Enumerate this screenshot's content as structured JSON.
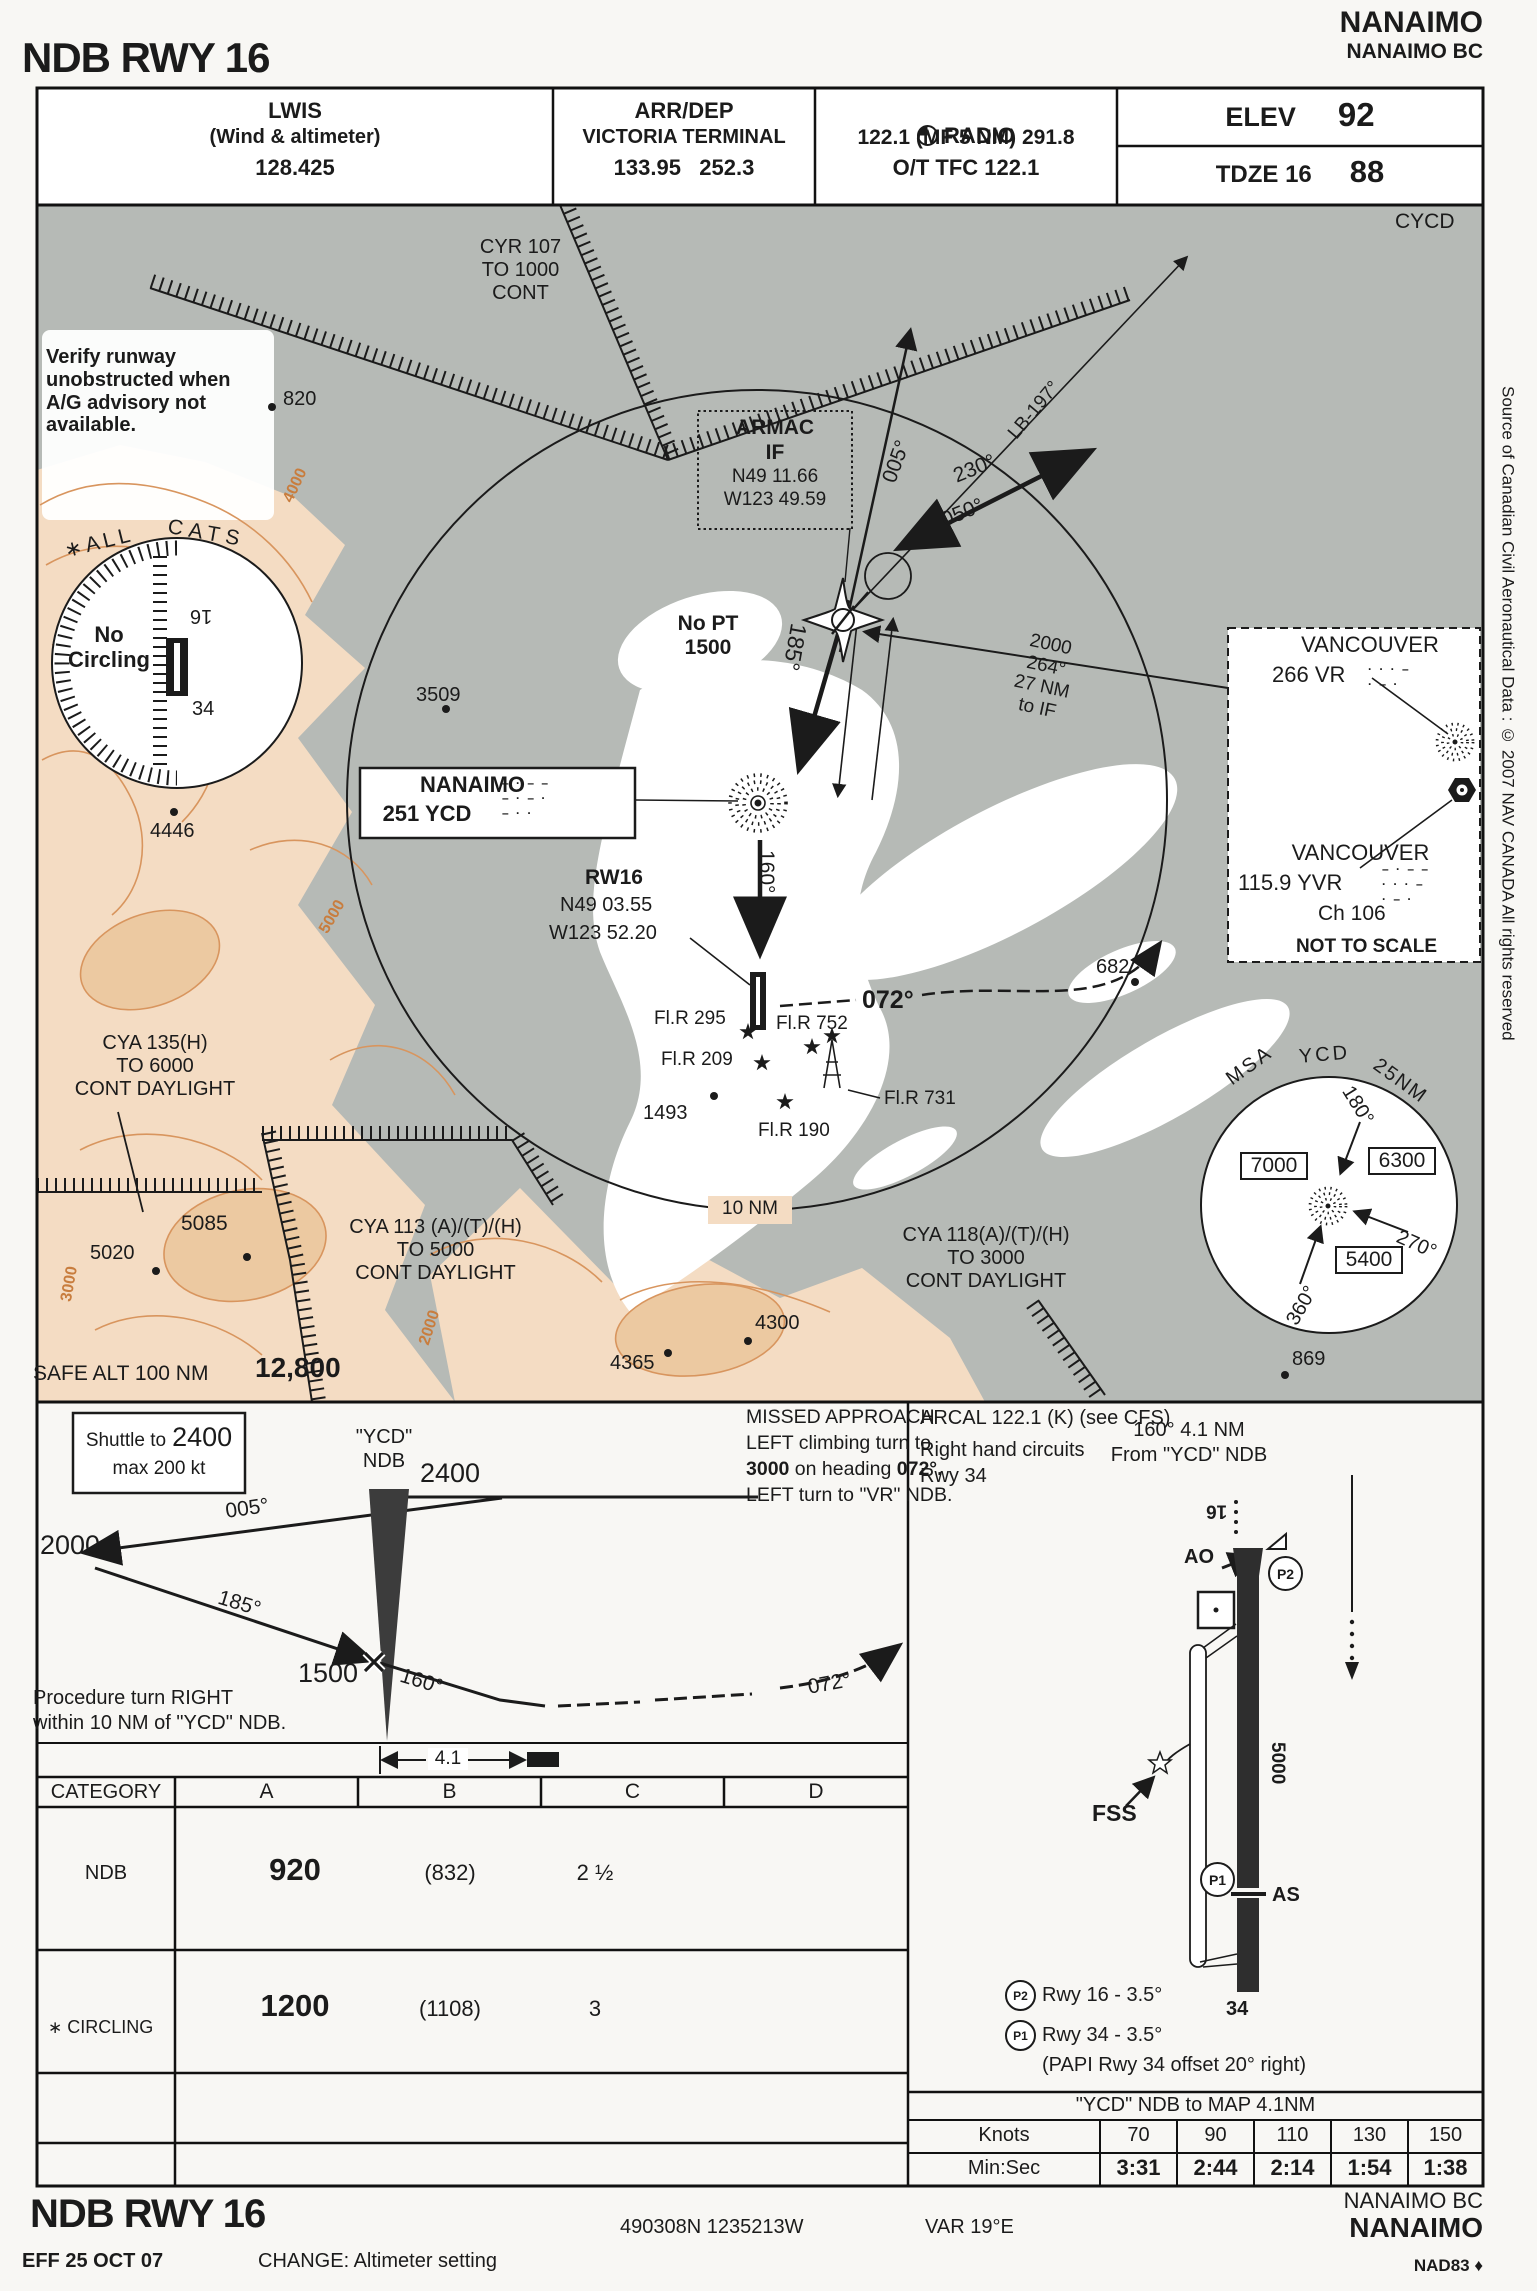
{
  "colors": {
    "water": "#b6bab6",
    "terrain": "#f4dcc3",
    "contour": "#d8955e",
    "ink": "#1b1b1b"
  },
  "header": {
    "title": "NDB RWY 16",
    "name": "NANAIMO",
    "location": "NANAIMO BC",
    "lwis": {
      "l1": "LWIS",
      "l2": "(Wind & altimeter)",
      "l3": "128.425"
    },
    "arrdep": {
      "l1": "ARR/DEP",
      "l2": "VICTORIA TERMINAL",
      "l3": "133.95   252.3"
    },
    "radio": {
      "l1": "RADIO",
      "l2": "122.1 (MF 5 NM) 291.8",
      "l3": "O/T TFC 122.1"
    },
    "elev_label": "ELEV",
    "elev": "92",
    "tdze_label": "TDZE 16",
    "tdze": "88"
  },
  "map": {
    "icao": "CYCD",
    "verify_note": "Verify runway\nunobstructed when\nA/G advisory not\navailable.",
    "cyr107": "CYR 107\nTO 1000\nCONT",
    "all_cats_1": "∗ALL",
    "all_cats_2": "CATS",
    "no_circling": "No\nCircling",
    "nc_16": "16",
    "nc_34": "34",
    "spot_820": "820",
    "spot_4446": "4446",
    "spot_3509": "3509",
    "spot_682": "682",
    "spot_1493": "1493",
    "spot_5085": "5085",
    "spot_5020": "5020",
    "spot_4300": "4300",
    "spot_4365": "4365",
    "spot_869": "869",
    "armac_name": "ARMAC",
    "armac_if": "IF",
    "armac_lat": "N49 11.66",
    "armac_lon": "W123 49.59",
    "brg_005": "005°",
    "brg_230": "230°",
    "brg_050": "050°",
    "lb_197": "LB-197°",
    "brg_185": "185°",
    "brg_160": "160°",
    "brg_072": "072°",
    "no_pt": "No PT\n1500",
    "feeder": "2000\n264°\n27 NM\nto IF",
    "ndb_name": "NANAIMO",
    "ndb_freq": "251 YCD",
    "ndb_morse": "– · – –\n– · – ·\n– · ·",
    "rw16": "RW16",
    "rw16_lat": "N49 03.55",
    "rw16_lon": "W123 52.20",
    "flr_295": "Fl.R 295",
    "flr_752": "Fl.R 752",
    "flr_209": "Fl.R 209",
    "flr_731": "Fl.R 731",
    "flr_190": "Fl.R 190",
    "cya_135": "CYA 135(H)\nTO 6000\nCONT DAYLIGHT",
    "cya_113": "CYA 113 (A)/(T)/(H)\nTO 5000\nCONT DAYLIGHT",
    "cya_118": "CYA 118(A)/(T)/(H)\nTO 3000\nCONT DAYLIGHT",
    "ring_10nm": "10  NM",
    "safe_alt_label": "SAFE ALT 100 NM",
    "safe_alt_value": "12,800",
    "contour_4000": "4000",
    "contour_3000": "3000",
    "contour_2000": "2000",
    "contour_5000": "5000"
  },
  "inset": {
    "name1": "VANCOUVER",
    "id1": "266 VR",
    "morse1": "· · · –\n· – ·",
    "name2": "VANCOUVER",
    "id2": "115.9 YVR",
    "morse2": "– · – –\n· · · –\n· – ·",
    "ch": "Ch 106",
    "nts": "NOT TO SCALE"
  },
  "msa": {
    "t1": "MSA",
    "t2": "YCD",
    "t3": "25NM",
    "v_w": "7000",
    "v_e": "6300",
    "v_s": "5400",
    "b180": "180°",
    "b270": "270°",
    "b360": "360°"
  },
  "margin_note": "Source of Canadian Civil Aeronautical Data : © 2007 NAV CANADA All rights reserved",
  "profile": {
    "shuttle_pre": "Shuttle to",
    "shuttle_alt": "2400",
    "shuttle_max": "max 200 kt",
    "alt2000": "2000",
    "brg005": "005°",
    "brg185": "185°",
    "alt1500": "1500",
    "brg160": "160°",
    "brg072": "072°",
    "ndb_q": "\"YCD\"",
    "ndb_lbl": "NDB",
    "alt2400": "2400",
    "proc_turn": "Procedure turn RIGHT\nwithin 10 NM of \"YCD\" NDB.",
    "dist": "4.1"
  },
  "missed": {
    "l1": "MISSED APPROACH",
    "l2": "LEFT climbing turn to",
    "l3a": "3000",
    "l3b": " on heading ",
    "l3c": "072°.",
    "l4": "LEFT turn to \"VR\" NDB."
  },
  "minima": {
    "headers": [
      "CATEGORY",
      "A",
      "B",
      "C",
      "D"
    ],
    "ndb_label": "NDB",
    "ndb_alt": "920",
    "ndb_paren": "(832)",
    "ndb_vis": "2 ½",
    "circ_star": "∗",
    "circ_label": "CIRCLING",
    "circ_alt": "1200",
    "circ_paren": "(1108)",
    "circ_vis": "3"
  },
  "sketch": {
    "arcal": "ARCAL 122.1 (K) (see CFS)",
    "circuits": "Right hand circuits\nRwy 34",
    "from_ndb": "160°  4.1 NM\nFrom \"YCD\" NDB",
    "rwy16": "16",
    "ao": "AO",
    "p2": "P2",
    "p1": "P1",
    "as_lbl": "AS",
    "rwy34": "34",
    "fss": "FSS",
    "length": "5000",
    "p2_note": "Rwy 16 - 3.5°",
    "p1_note": "Rwy 34 - 3.5°",
    "papi_note": "(PAPI Rwy 34 offset 20° right)"
  },
  "speed": {
    "title": "\"YCD\" NDB to MAP 4.1NM",
    "knots_label": "Knots",
    "times_label": "Min:Sec",
    "knots": [
      "70",
      "90",
      "110",
      "130",
      "150"
    ],
    "times": [
      "3:31",
      "2:44",
      "2:14",
      "1:54",
      "1:38"
    ]
  },
  "footer": {
    "title": "NDB RWY 16",
    "coords": "490308N 1235213W",
    "var": "VAR 19°E",
    "location": "NANAIMO BC",
    "name": "NANAIMO",
    "datum": "NAD83 ♦",
    "eff": "EFF 25 OCT 07",
    "change": "CHANGE: Altimeter setting"
  }
}
